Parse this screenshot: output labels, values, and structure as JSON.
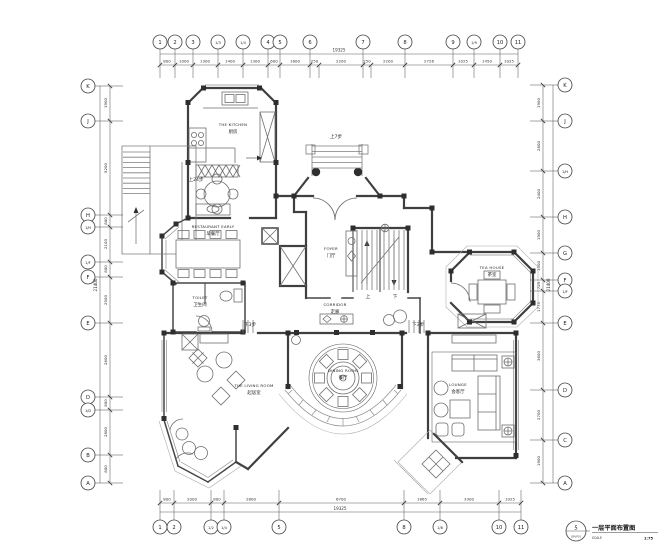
{
  "title_block": {
    "number": "5",
    "code": "QP-JP01",
    "name": "一层平面布置图",
    "scale_label": "SCALE",
    "scale_value": "1:75"
  },
  "grid": {
    "top": {
      "y": 42,
      "r": 7,
      "stem_to": 65,
      "bubbles": [
        {
          "label": "1",
          "x": 160
        },
        {
          "label": "2",
          "x": 175
        },
        {
          "label": "3",
          "x": 193
        },
        {
          "label": "1/3",
          "x": 218
        },
        {
          "label": "1/4",
          "x": 243
        },
        {
          "label": "4",
          "x": 268
        },
        {
          "label": "5",
          "x": 280
        },
        {
          "label": "6",
          "x": 310
        },
        {
          "label": "7",
          "x": 363
        },
        {
          "label": "8",
          "x": 405
        },
        {
          "label": "9",
          "x": 453
        },
        {
          "label": "1/9",
          "x": 474
        },
        {
          "label": "10",
          "x": 500
        },
        {
          "label": "11",
          "x": 518
        }
      ]
    },
    "bottom": {
      "y": 527,
      "r": 7,
      "stem_to": 503,
      "bubbles": [
        {
          "label": "1",
          "x": 160
        },
        {
          "label": "2",
          "x": 174
        },
        {
          "label": "1/2",
          "x": 211
        },
        {
          "label": "1/4",
          "x": 224
        },
        {
          "label": "5",
          "x": 279
        },
        {
          "label": "8",
          "x": 404
        },
        {
          "label": "1/8",
          "x": 440
        },
        {
          "label": "10",
          "x": 499
        },
        {
          "label": "11",
          "x": 521
        }
      ]
    },
    "left": {
      "x": 88,
      "r": 7,
      "stem_to": 110,
      "bubbles": [
        {
          "label": "K",
          "y": 86
        },
        {
          "label": "J",
          "y": 121
        },
        {
          "label": "H",
          "y": 215
        },
        {
          "label": "1/H",
          "y": 227
        },
        {
          "label": "1/F",
          "y": 262
        },
        {
          "label": "F",
          "y": 277
        },
        {
          "label": "E",
          "y": 323
        },
        {
          "label": "D",
          "y": 397
        },
        {
          "label": "1/D",
          "y": 410
        },
        {
          "label": "B",
          "y": 455
        },
        {
          "label": "A",
          "y": 483
        }
      ]
    },
    "right": {
      "x": 565,
      "r": 7,
      "stem_to": 543,
      "bubbles": [
        {
          "label": "K",
          "y": 85
        },
        {
          "label": "J",
          "y": 121
        },
        {
          "label": "1/H",
          "y": 171
        },
        {
          "label": "H",
          "y": 217
        },
        {
          "label": "G",
          "y": 253
        },
        {
          "label": "F",
          "y": 280
        },
        {
          "label": "1/F",
          "y": 291
        },
        {
          "label": "E",
          "y": 323
        },
        {
          "label": "D",
          "y": 390
        },
        {
          "label": "C",
          "y": 440
        },
        {
          "label": "A",
          "y": 483
        }
      ]
    }
  },
  "dims": {
    "top": {
      "line1": 54,
      "line2": 65,
      "from": 160,
      "to": 518,
      "total": "19325",
      "total_x": 339,
      "total_y": 51.5,
      "num": 62.5,
      "ext": 13,
      "ticks": [
        160,
        175,
        193,
        218,
        243,
        268,
        280,
        310,
        319,
        363,
        371,
        405,
        453,
        474,
        500,
        518
      ],
      "items": [
        [
          "800",
          167
        ],
        [
          "1000",
          184
        ],
        [
          "1300",
          205
        ],
        [
          "1400",
          230
        ],
        [
          "1300",
          255
        ],
        [
          "600",
          274
        ],
        [
          "1600",
          295
        ],
        [
          "250",
          314.5
        ],
        [
          "2200",
          341
        ],
        [
          "250",
          367
        ],
        [
          "2200",
          388
        ],
        [
          "2726",
          429
        ],
        [
          "1025",
          463
        ],
        [
          "1450",
          487
        ],
        [
          "1025",
          509
        ]
      ]
    },
    "bottom": {
      "line1": 512,
      "line2": 503,
      "from": 160,
      "to": 521,
      "total": "19325",
      "total_x": 340,
      "total_y": 510,
      "num": 500.5,
      "ext": -13,
      "ticks": [
        160,
        174,
        211,
        224,
        279,
        404,
        440,
        499,
        521
      ],
      "items": [
        [
          "800",
          167
        ],
        [
          "2000",
          192
        ],
        [
          "800",
          217
        ],
        [
          "2800",
          251
        ],
        [
          "6700",
          341
        ],
        [
          "1865",
          422
        ],
        [
          "3300",
          469
        ],
        [
          "1025",
          510
        ]
      ]
    },
    "left": {
      "line1": 100,
      "line2": 110,
      "from": 86,
      "to": 483,
      "total": "21400",
      "total_x": 97,
      "total_y": 285,
      "num": 107,
      "ext": 13,
      "ticks": [
        86,
        121,
        215,
        227,
        262,
        277,
        323,
        397,
        410,
        455,
        483
      ],
      "items": [
        [
          "1900",
          103
        ],
        [
          "5200",
          168
        ],
        [
          "800",
          221
        ],
        [
          "2100",
          244
        ],
        [
          "800",
          269
        ],
        [
          "2500",
          300
        ],
        [
          "2600",
          360
        ],
        [
          "800",
          403
        ],
        [
          "2800",
          432
        ],
        [
          "800",
          469
        ]
      ]
    },
    "right": {
      "line1": 553,
      "line2": 543,
      "from": 85,
      "to": 483,
      "total": "21400",
      "total_x": 550,
      "total_y": 285,
      "num": 540,
      "ext": -13,
      "ticks": [
        85,
        121,
        171,
        217,
        253,
        280,
        291,
        323,
        390,
        440,
        483
      ],
      "items": [
        [
          "1900",
          103
        ],
        [
          "2800",
          146
        ],
        [
          "2400",
          194
        ],
        [
          "1900",
          235
        ],
        [
          "1500",
          266
        ],
        [
          "725",
          285.5
        ],
        [
          "1775",
          307
        ],
        [
          "3600",
          356
        ],
        [
          "2700",
          415
        ],
        [
          "1900",
          461
        ]
      ]
    }
  },
  "rooms": [
    {
      "id": "kitchen",
      "en": "THE KITCHEN",
      "cn": "厨房",
      "x": 233,
      "y": 126
    },
    {
      "id": "restaurant",
      "en": "RESTAURANT EARLY",
      "cn": "早餐厅",
      "x": 213,
      "y": 228
    },
    {
      "id": "toilet",
      "en": "TOILET",
      "cn": "卫生间",
      "x": 200,
      "y": 299
    },
    {
      "id": "foyer",
      "en": "FOYER",
      "cn": "门厅",
      "x": 331,
      "y": 250
    },
    {
      "id": "corridor",
      "en": "CORRIDOR",
      "cn": "走廊",
      "x": 335,
      "y": 306
    },
    {
      "id": "tea-house",
      "en": "TEA HOUSE",
      "cn": "茶室",
      "x": 492,
      "y": 269
    },
    {
      "id": "dining-room",
      "en": "DINING ROOM",
      "cn": "餐厅",
      "x": 343,
      "y": 372
    },
    {
      "id": "living-room",
      "en": "THE LIVING ROOM",
      "cn": "起居室",
      "x": 254,
      "y": 387
    },
    {
      "id": "lounge",
      "en": "LOUNGE",
      "cn": "会客厅",
      "x": 458,
      "y": 386
    }
  ],
  "annotations": [
    {
      "id": "entry-steps",
      "text": "上7步",
      "x": 336,
      "y": 138
    },
    {
      "id": "ext-stair-steps",
      "text": "上24步",
      "x": 196,
      "y": 181
    },
    {
      "id": "steps-down-left",
      "text": "下3步",
      "x": 250,
      "y": 326
    },
    {
      "id": "steps-down-right",
      "text": "下3步",
      "x": 418,
      "y": 326
    },
    {
      "id": "stair-up",
      "text": "上",
      "x": 368,
      "y": 298
    },
    {
      "id": "stair-down",
      "text": "下",
      "x": 395,
      "y": 298
    }
  ]
}
